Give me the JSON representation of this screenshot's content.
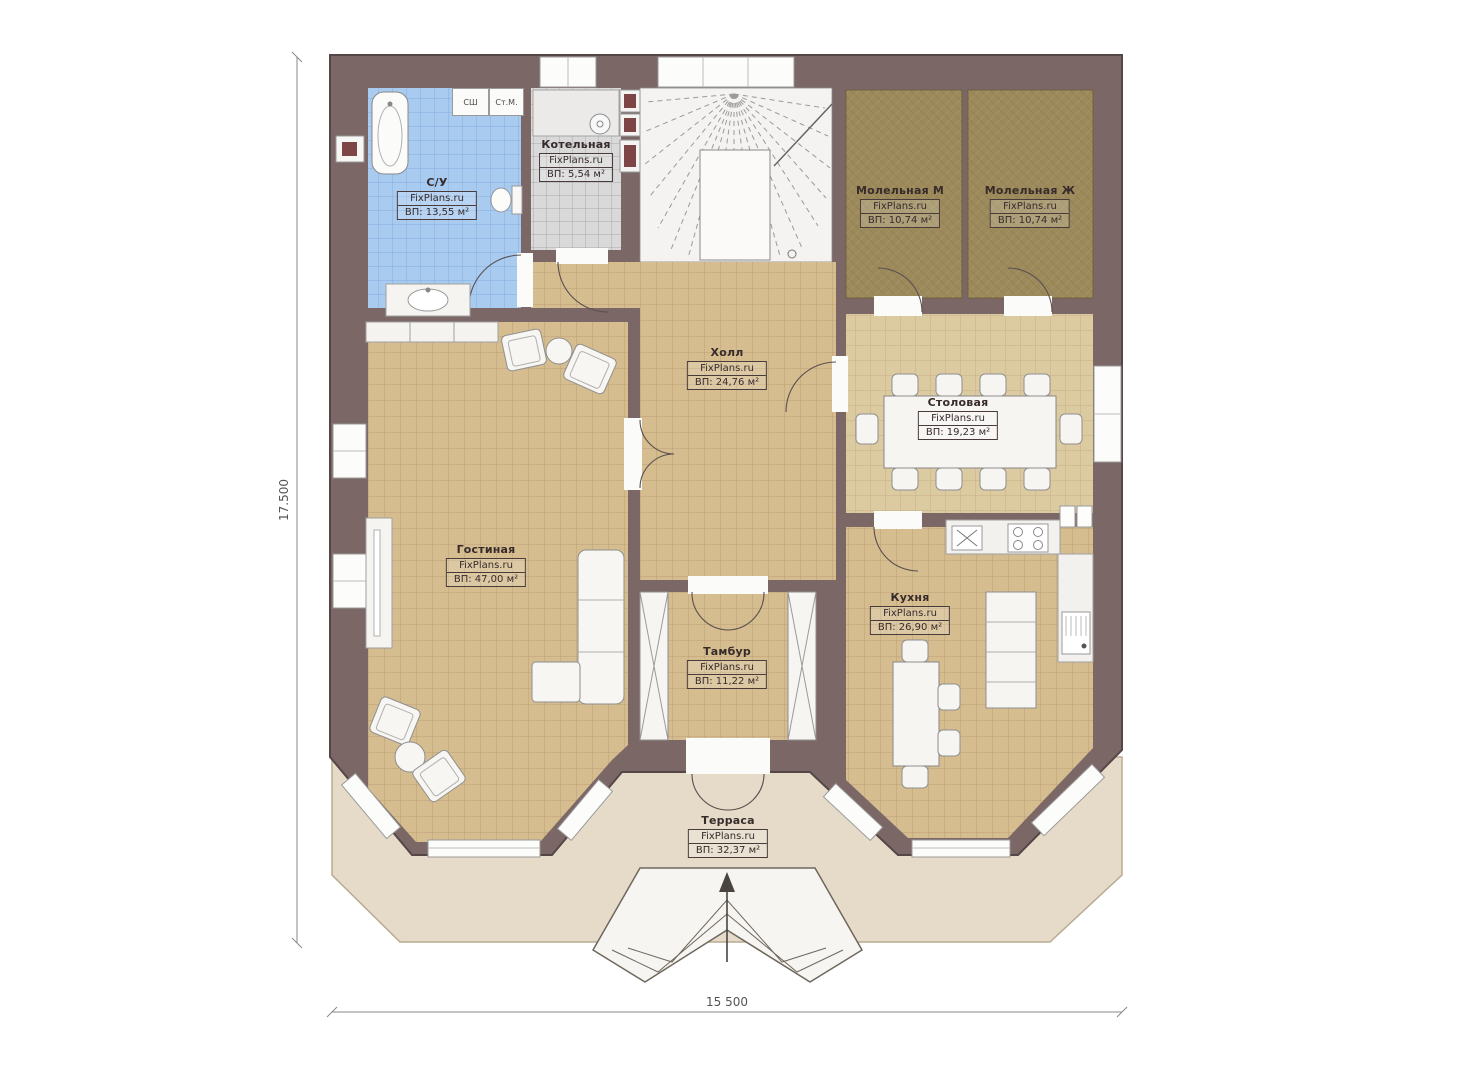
{
  "plan": {
    "brand": "FixPlans.ru",
    "dimensions": {
      "height": "17.500",
      "width": "15 500"
    },
    "colors": {
      "wall": "#7c6767",
      "wall_outline": "#554747",
      "floor_main": "#d5bd90",
      "floor_main_grid": "#a8875d",
      "floor_dining": "#dccaa1",
      "floor_bathroom": "#a9cbf0",
      "floor_boiler": "#d9d9d9",
      "floor_prayer": "#9c8a5b",
      "terrace": "#e5dbc8",
      "fixture": "#f6f5f2"
    },
    "rooms": [
      {
        "name": "С/У",
        "site": "FixPlans.ru",
        "area": "ВП: 13,55 м²"
      },
      {
        "name": "Котельная",
        "site": "FixPlans.ru",
        "area": "ВП: 5,54 м²"
      },
      {
        "name": "Молельная М",
        "site": "FixPlans.ru",
        "area": "ВП: 10,74 м²"
      },
      {
        "name": "Молельная Ж",
        "site": "FixPlans.ru",
        "area": "ВП: 10,74 м²"
      },
      {
        "name": "Холл",
        "site": "FixPlans.ru",
        "area": "ВП: 24,76 м²"
      },
      {
        "name": "Столовая",
        "site": "FixPlans.ru",
        "area": "ВП: 19,23 м²"
      },
      {
        "name": "Гостиная",
        "site": "FixPlans.ru",
        "area": "ВП: 47,00 м²"
      },
      {
        "name": "Кухня",
        "site": "FixPlans.ru",
        "area": "ВП: 26,90 м²"
      },
      {
        "name": "Тамбур",
        "site": "FixPlans.ru",
        "area": "ВП: 11,22 м²"
      },
      {
        "name": "Терраса",
        "site": "FixPlans.ru",
        "area": "ВП: 32,37 м²"
      }
    ],
    "appliances": [
      {
        "label": "СШ"
      },
      {
        "label": "Ст.М."
      }
    ],
    "icons": {
      "entry_arrow": "up-arrow",
      "kitchen_sink_mark": "x-cross"
    }
  }
}
